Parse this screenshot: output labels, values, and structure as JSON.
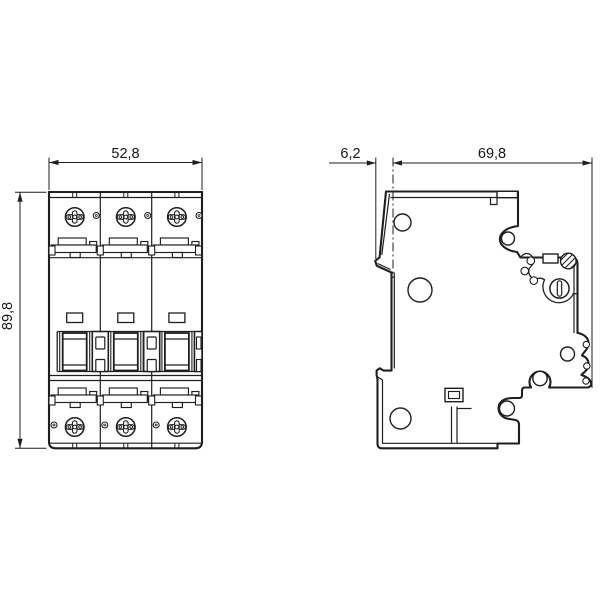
{
  "page": {
    "background": "#ffffff"
  },
  "drawing": {
    "description": "Dimensional line drawing of a 3-pole miniature circuit breaker: front view (left) and side profile view (right)",
    "line_color": "#1f1f1f",
    "front_view": {
      "width_label": "52,8",
      "height_label": "89,8"
    },
    "side_view": {
      "offset_label": "6,2",
      "depth_label": "69,8"
    }
  }
}
